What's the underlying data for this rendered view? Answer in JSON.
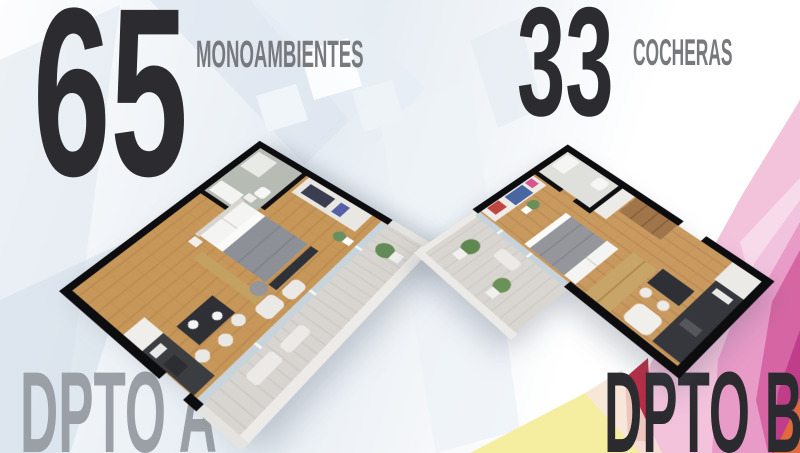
{
  "stats": [
    {
      "value": "65",
      "label": "MONOAMBIENTES"
    },
    {
      "value": "33",
      "label": "COCHERAS"
    }
  ],
  "plans": [
    {
      "caption": "DPTO A"
    },
    {
      "caption": "DPTO B"
    }
  ],
  "palette": {
    "headline": "#2b2b30",
    "sublabel": "#77797d",
    "caption_a": "#9aa0a5",
    "caption_b": "#2b2b2f",
    "background_blue": "#dbe4ee",
    "accent_pink_light": "#f3c3dc",
    "accent_pink": "#e897c5",
    "accent_magenta": "#cf4f9b",
    "accent_dark_magenta": "#bf3b88",
    "accent_red": "#b92c46",
    "accent_yellow": "#f5eda0",
    "accent_orange": "#df6a3e",
    "wall": "#0d0d0f",
    "wood_floor": "#c79759",
    "balcony_deck": "#d8d5d0"
  }
}
